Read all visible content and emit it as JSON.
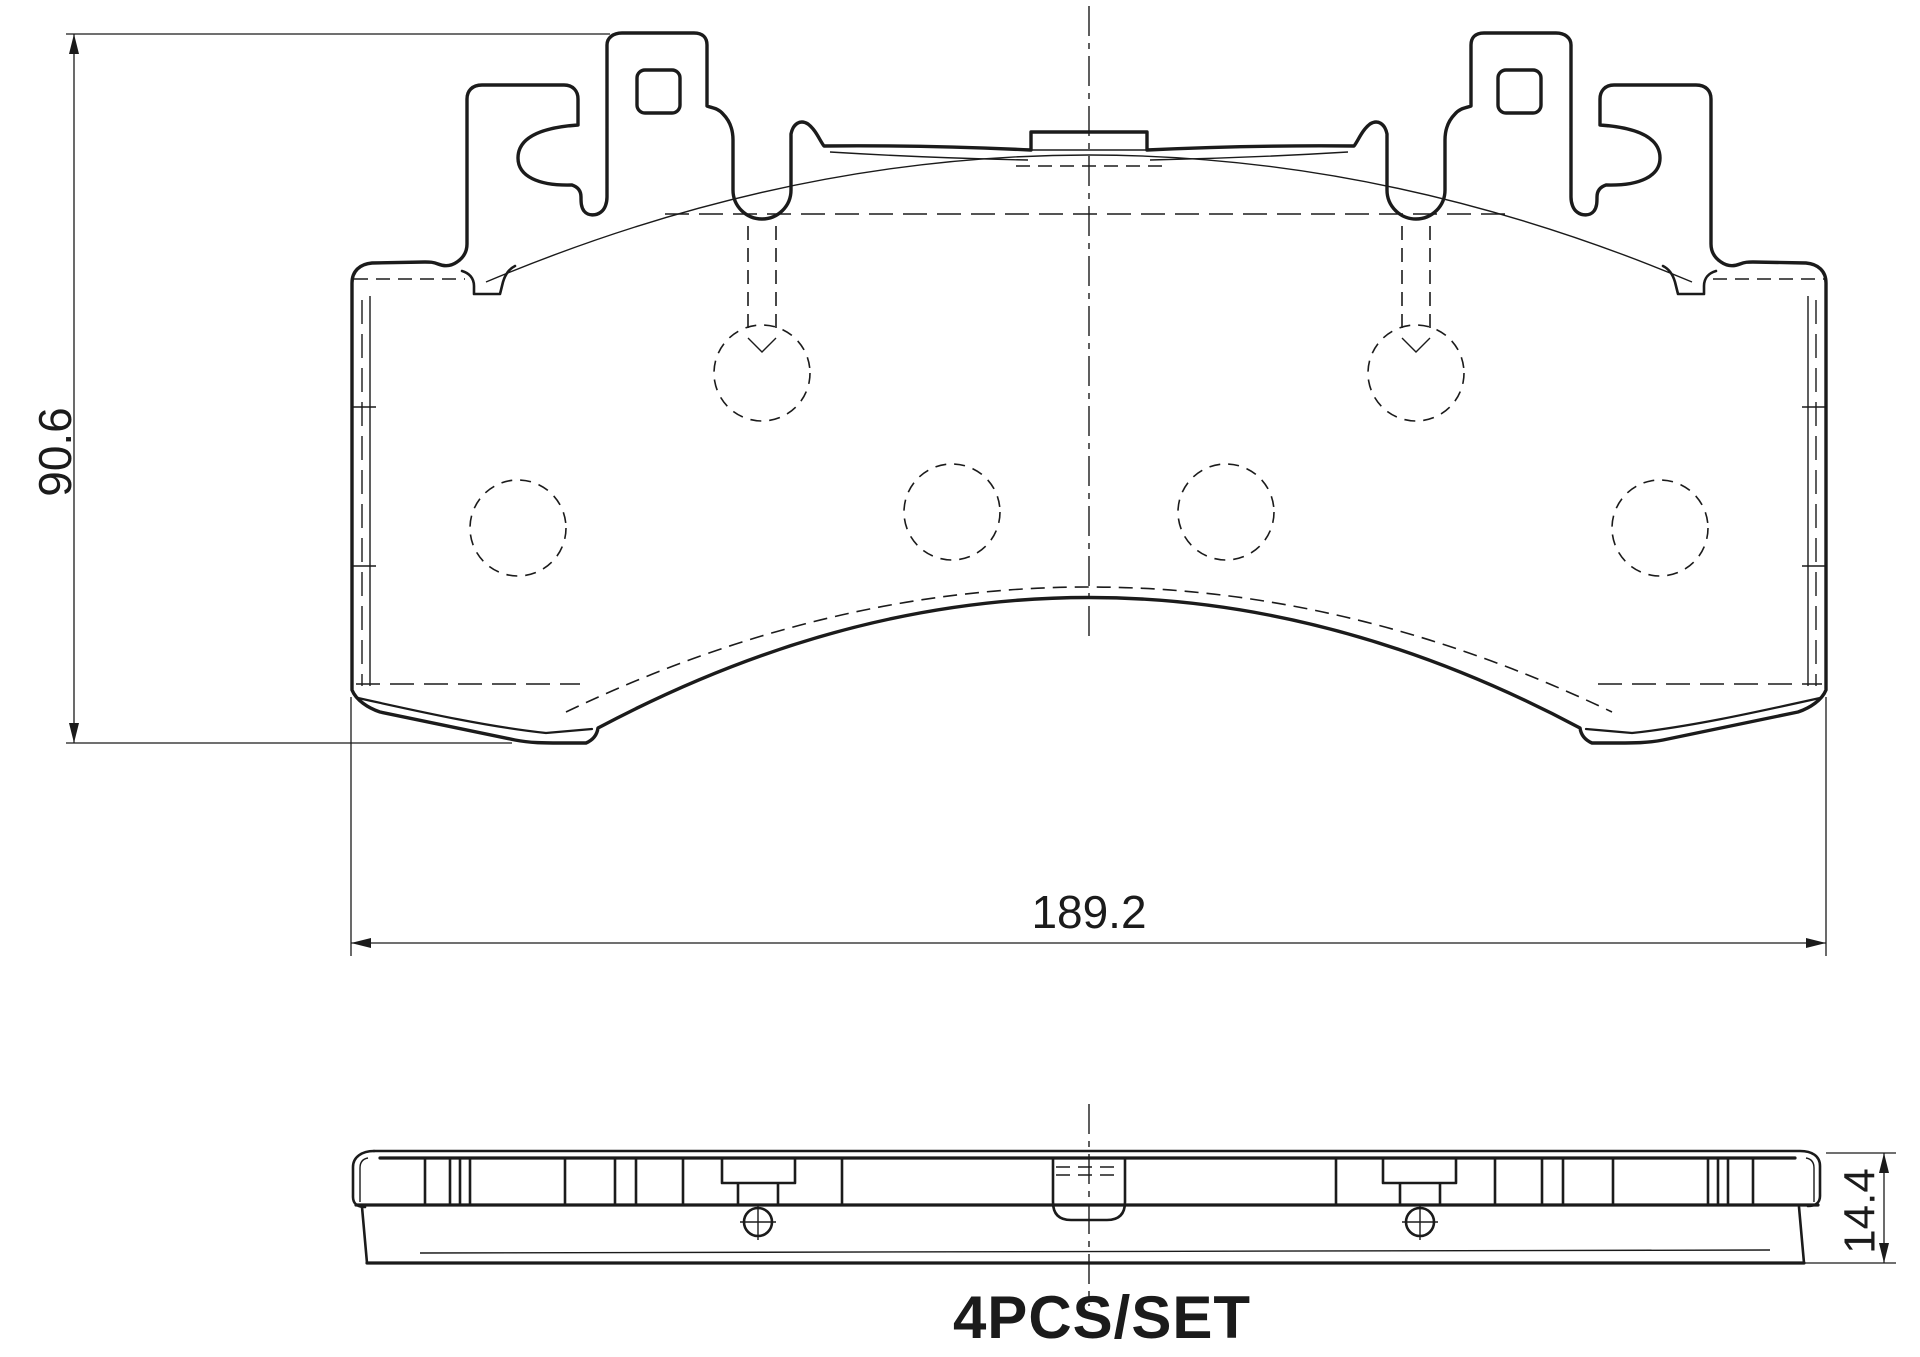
{
  "drawing": {
    "type": "engineering-drawing",
    "subject": "brake pad set, front profile view and bottom thickness view",
    "background_color": "#ffffff",
    "line_color": "#1b1b1b",
    "labels": {
      "height": "90.6",
      "width": "189.2",
      "thickness": "14.4",
      "set": "4PCS/SET"
    }
  }
}
